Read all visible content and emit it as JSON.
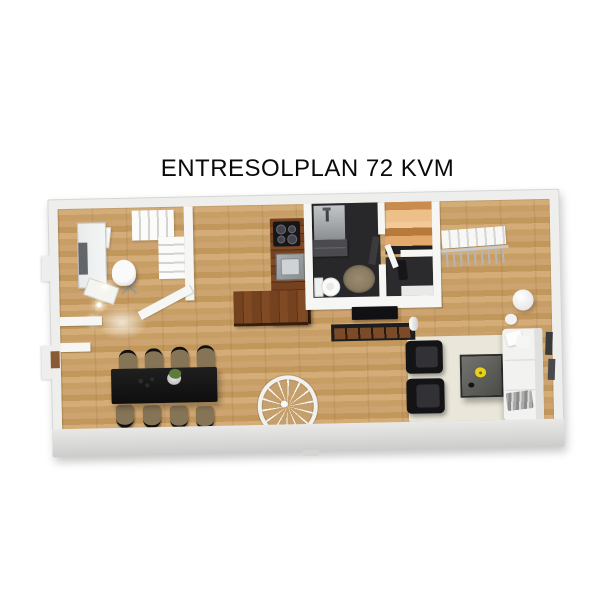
{
  "title": "ENTRESOLPLAN 72 KVM",
  "floorplan": {
    "type": "3d-top-down-floor-plan",
    "level_name": "ENTRESOLPLAN",
    "area_kvm": "72",
    "rooms": [
      "home-office",
      "entry-hall",
      "kitchen",
      "bathroom",
      "sauna",
      "inner-hall",
      "dining-area",
      "living-room",
      "stairwell"
    ],
    "fixtures": [
      "l-shaped-staircase",
      "spiral-staircase",
      "open-stairwell-railing",
      "front-door",
      "shower",
      "vanity",
      "toilet",
      "cooktop",
      "sink"
    ],
    "furniture": [
      "desk",
      "office-chair",
      "green-wall-art",
      "dining-table-8-chairs",
      "table-plant",
      "tv",
      "tv-bench",
      "white-vase",
      "two-armchairs",
      "coffee-table",
      "yellow-flowers",
      "white-sofa",
      "pillows",
      "gray-throw",
      "area-rug",
      "round-bath-rug",
      "cylinder-side-table",
      "wall-frames",
      "coat-hooks"
    ]
  },
  "colors": {
    "background": "#ffffff",
    "title_text": "#0a0a0a",
    "wall": "#f6f6f4",
    "outer_slab": "#eeeeec",
    "wood_floor": "#cda470",
    "kitchen_counter": "#74421f",
    "sauna_wood": "#eec089",
    "bathroom_floor": "#28282b",
    "dining_table": "#161616",
    "chair_seat": "#867456",
    "armchair": "#141416",
    "living_rug": "#eae7da",
    "sofa": "#f2f2f0",
    "flower_accent": "#e8d020"
  }
}
